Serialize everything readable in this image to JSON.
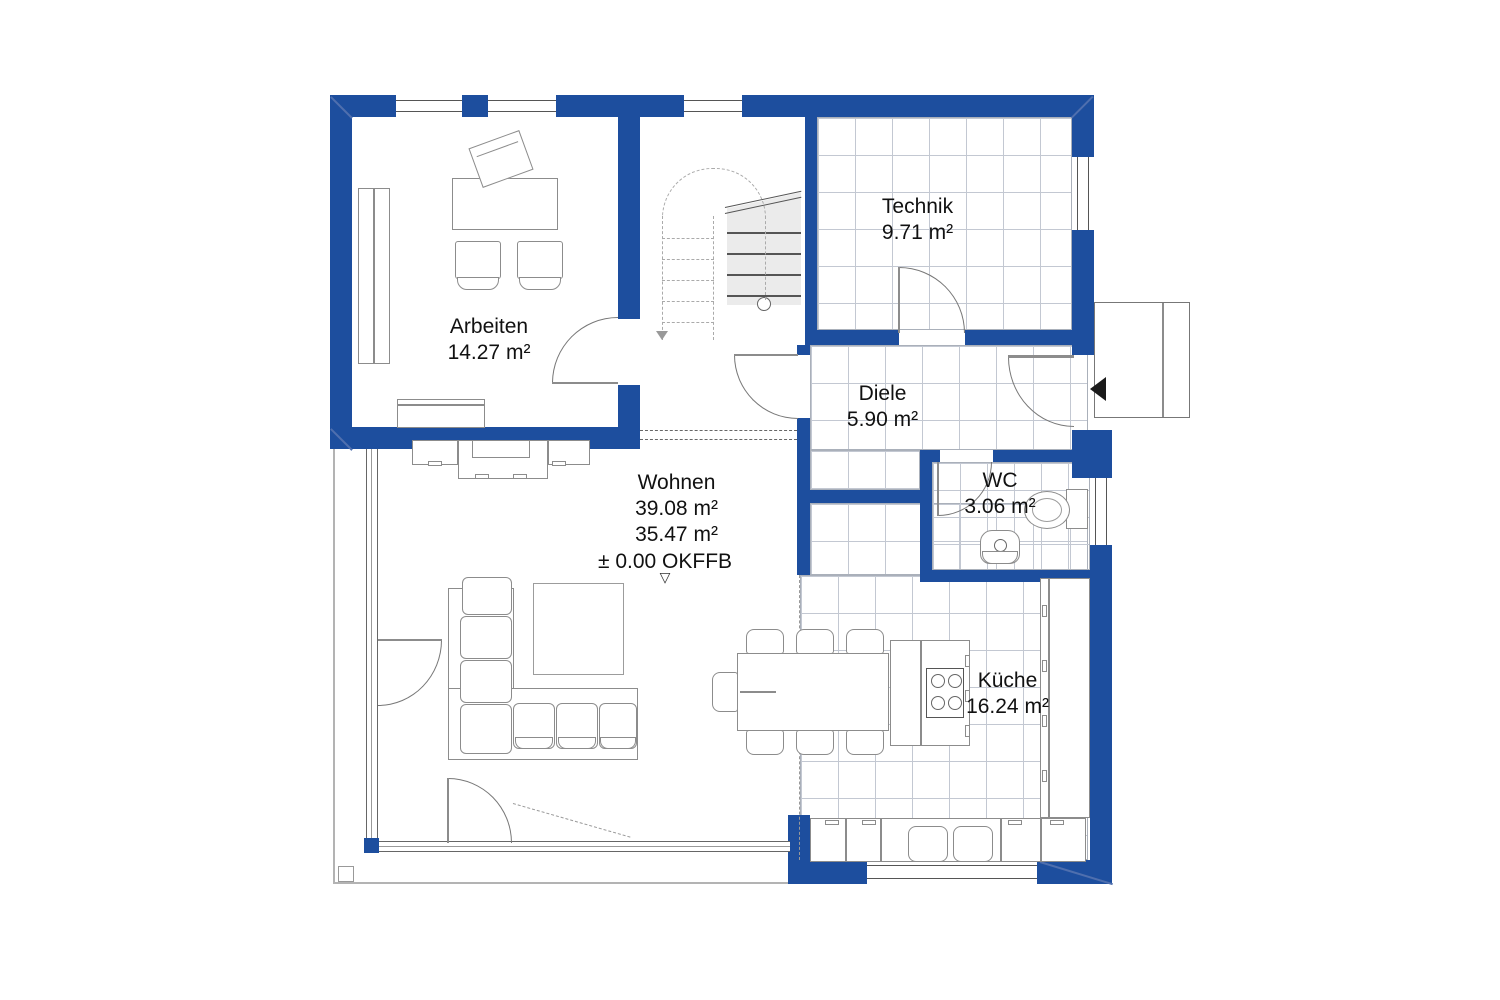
{
  "plan": {
    "rooms": {
      "arbeiten": {
        "name": "Arbeiten",
        "area": "14.27 m²"
      },
      "technik": {
        "name": "Technik",
        "area": "9.71 m²"
      },
      "diele": {
        "name": "Diele",
        "area": "5.90 m²"
      },
      "wc": {
        "name": "WC",
        "area": "3.06 m²"
      },
      "wohnen": {
        "name": "Wohnen",
        "area_gross": "39.08 m²",
        "area_net": "35.47 m²"
      },
      "kueche": {
        "name": "Küche",
        "area": "16.24 m²"
      }
    },
    "level_marker": {
      "text": "± 0.00 OKFFB",
      "symbol": "▽"
    },
    "icons": {
      "entrance_arrow": "left-filled-triangle",
      "level_datum": "white-down-triangle"
    },
    "colors": {
      "wall": "#1d4e9e",
      "stair_fill": "#ebebeb",
      "tile_line": "#c3c8d2"
    }
  }
}
